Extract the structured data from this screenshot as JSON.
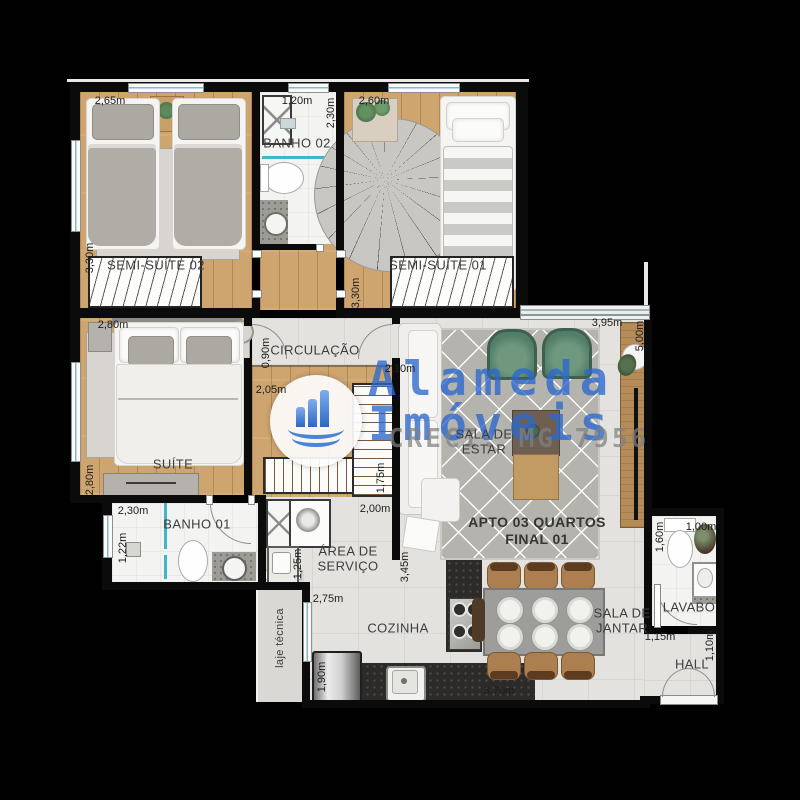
{
  "watermark": {
    "brand_line1": "Alameda",
    "brand_line2": "Imóveis",
    "creci": "CRECI: MG 7956",
    "logo_icon": "building-bars-wave-icon"
  },
  "plan": {
    "unit_title_line1": "APTO 03 QUARTOS",
    "unit_title_line2": "FINAL 01",
    "rooms": {
      "semi_suite_02": {
        "label": "SEMI-SUÍTE 02",
        "width": "2,65m",
        "depth": "3,30m"
      },
      "banho_02": {
        "label": "BANHO 02",
        "width": "1,20m",
        "depth": "2,30m"
      },
      "semi_suite_01": {
        "label": "SEMI-SUÍTE 01",
        "width": "2,60m",
        "depth": "3,30m"
      },
      "circulacao": {
        "label": "CIRCULAÇÃO",
        "width": "0,90m",
        "length": "2,10m",
        "leg": "2,05m"
      },
      "suite": {
        "label": "SUÍTE",
        "width": "2,80m",
        "depth": "2,80m",
        "closet_depth": "1,75m"
      },
      "banho_01": {
        "label": "BANHO 01",
        "width": "2,30m",
        "depth": "1,22m"
      },
      "area_servico": {
        "label_line1": "ÁREA DE",
        "label_line2": "SERVIÇO",
        "width": "2,00m",
        "side": "1,25m",
        "length": "2,75m"
      },
      "sala_estar": {
        "label_line1": "SALA DE",
        "label_line2": "ESTAR",
        "width": "3,95m",
        "depth": "5,00m"
      },
      "cozinha": {
        "label": "COZINHA",
        "depth": "3,45m",
        "width": "3,70m",
        "fridge": "1,90m"
      },
      "sala_jantar": {
        "label_line1": "SALA DE",
        "label_line2": "JANTAR"
      },
      "lavabo": {
        "label": "LAVABO",
        "depth": "1,60m",
        "width": "1,00m"
      },
      "hall": {
        "label": "HALL",
        "width": "1,15m",
        "depth": "1,10m"
      },
      "laje_tecnica": {
        "label": "laje técnica"
      }
    }
  },
  "colors": {
    "wall": "#0b0b0b",
    "wood_floor": "#cfa56f",
    "tile_floor": "#e3e2df",
    "window_accent_teal": "#3fb6c9",
    "watermark_blue": "#2c68ce",
    "armchair_green": "#527d68"
  }
}
